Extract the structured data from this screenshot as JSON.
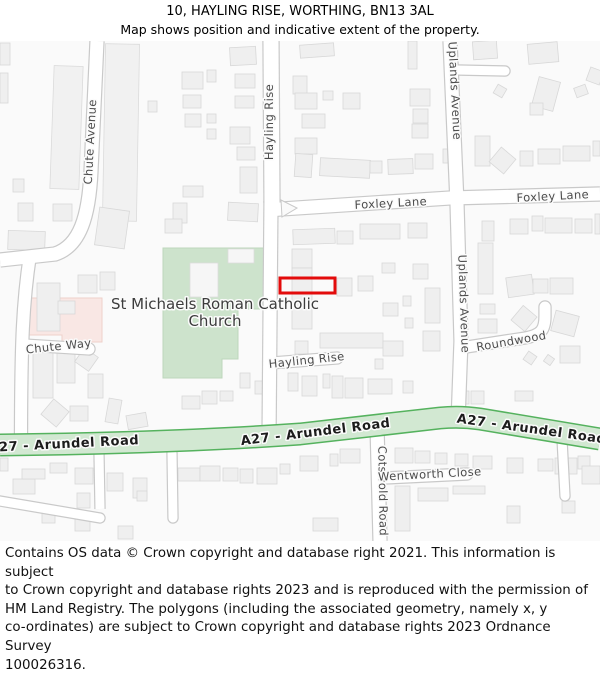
{
  "header": {
    "title": "10, HAYLING RISE, WORTHING, BN13 3AL",
    "subtitle": "Map shows position and indicative extent of the property."
  },
  "footer": {
    "lines": [
      "Contains OS data © Crown copyright and database right 2021. This information is subject",
      "to Crown copyright and database rights 2023 and is reproduced with the permission of",
      "HM Land Registry. The polygons (including the associated geometry, namely x, y",
      "co-ordinates) are subject to Crown copyright and database rights 2023 Ordnance Survey",
      "100026316."
    ]
  },
  "map": {
    "colors": {
      "land": "#fafafa",
      "building_fill": "#efefef",
      "building_stroke": "#d8d8d8",
      "strip_fill": "#f1f1f1",
      "strip_stroke": "#dbdbdb",
      "road_fill": "#ffffff",
      "road_casing": "#c9c9c9",
      "church_fill": "#cde3cc",
      "church_stroke": "#bdd7bc",
      "church_building_fill": "#f6f6f6",
      "pink_fill": "#f9e7e4",
      "pink_stroke": "#eed0ca",
      "a27_fill": "#d2e8d2",
      "a27_casing": "#55b25e",
      "label_color": "#4c4c4c",
      "a27_label_color": "#1c1c1c",
      "church_label_color": "#3c3c3c",
      "halo": "#fbfbfb",
      "marker": "#e30b0b"
    },
    "church": {
      "points": "163,207 265,207 265,268 238,268 238,318 222,318 222,337 163,337",
      "label_line1": "St Michaels Roman Catholic",
      "label_line2": "Church",
      "lx": 215,
      "ly1": 268,
      "ly2": 285,
      "buildings": [
        [
          190,
          222,
          28,
          34,
          0
        ],
        [
          228,
          208,
          26,
          14,
          0
        ]
      ]
    },
    "pink_area": {
      "points": "28,257 102,257 102,301 62,301 62,294 28,294"
    },
    "strips": [
      [
        52,
        25,
        29,
        123,
        2
      ],
      [
        104,
        3,
        34,
        177,
        1
      ]
    ],
    "roads": [
      {
        "name": "chute-avenue",
        "d": "M 97,0 L 91,130 C 89,175 80,205 55,213 L 0,219",
        "w": 13
      },
      {
        "name": "chute-avenue-south",
        "d": "M 30,214 C 23,260 21,300 21,402",
        "w": 12
      },
      {
        "name": "chute-way",
        "d": "M 25,304 L 89,308",
        "w": 11,
        "cap": "round"
      },
      {
        "name": "hayling-rise-north",
        "d": "M 271,0 L 272,162",
        "w": 15
      },
      {
        "name": "foxley-lane",
        "d": "M 266,169 L 450,157 L 600,153",
        "w": 13
      },
      {
        "name": "hayling-rise-south",
        "d": "M 271,160 L 269,398",
        "w": 13
      },
      {
        "name": "hayling-rise-stub",
        "d": "M 271,322 L 337,317",
        "w": 11,
        "cap": "round"
      },
      {
        "name": "uplands-avenue",
        "d": "M 450,0 L 457,162 L 461,300 L 458,380",
        "w": 13
      },
      {
        "name": "uplands-side-road",
        "d": "M 457,29 L 505,30",
        "w": 9,
        "cap": "round"
      },
      {
        "name": "roundwood",
        "d": "M 460,307 L 525,297 C 542,294 545,288 545,275 L 545,266",
        "w": 11,
        "cap": "round"
      },
      {
        "name": "cotswold-road",
        "d": "M 377,385 L 380,500",
        "w": 13
      },
      {
        "name": "wentworth-close",
        "d": "M 385,437 L 467,433",
        "w": 11,
        "cap": "round"
      },
      {
        "name": "driveway-1",
        "d": "M 99,412 L 100,468",
        "w": 9
      },
      {
        "name": "driveway-2",
        "d": "M 172,412 L 173,477",
        "w": 9,
        "cap": "round"
      },
      {
        "name": "driveway-3",
        "d": "M 562,398 L 565,455",
        "w": 9,
        "cap": "round"
      },
      {
        "name": "bottom-left-lane",
        "d": "M 0,460 L 100,477",
        "w": 9,
        "cap": "round"
      }
    ],
    "junction_island": "281,159 297,167 282,176",
    "a27": {
      "d": "M 0,404 C 90,403 200,400 300,393 L 440,377 Q 460,375 480,378 L 600,398",
      "w": 20,
      "labels": [
        {
          "text": "A27 - Arundel Road",
          "x": 64,
          "y": 407,
          "r": -3
        },
        {
          "text": "A27 - Arundel Road",
          "x": 316,
          "y": 395,
          "r": -7
        },
        {
          "text": "A27 - Arundel Road",
          "x": 531,
          "y": 392,
          "r": 8
        }
      ]
    },
    "road_labels": [
      {
        "text": "Chute Avenue",
        "x": 94,
        "y": 101,
        "r": -87
      },
      {
        "text": "Hayling Rise",
        "x": 273,
        "y": 81,
        "r": -90
      },
      {
        "text": "Uplands Avenue",
        "x": 451,
        "y": 50,
        "r": 87
      },
      {
        "text": "Uplands Avenue",
        "x": 460,
        "y": 263,
        "r": 88
      },
      {
        "text": "Foxley Lane",
        "x": 391,
        "y": 166,
        "r": -3
      },
      {
        "text": "Foxley Lane",
        "x": 553,
        "y": 159,
        "r": -3
      },
      {
        "text": "Chute Way",
        "x": 59,
        "y": 309,
        "r": -6
      },
      {
        "text": "Hayling Rise",
        "x": 307,
        "y": 323,
        "r": -6
      },
      {
        "text": "Roundwood",
        "x": 512,
        "y": 304,
        "r": -10
      },
      {
        "text": "Cotswold Road",
        "x": 379,
        "y": 450,
        "r": 89
      },
      {
        "text": "Wentworth Close",
        "x": 430,
        "y": 437,
        "r": -3
      }
    ],
    "buildings": [
      [
        0,
        2,
        10,
        22,
        0
      ],
      [
        0,
        32,
        8,
        30,
        0
      ],
      [
        13,
        138,
        11,
        13,
        0
      ],
      [
        18,
        162,
        15,
        18,
        0
      ],
      [
        53,
        163,
        19,
        17,
        0
      ],
      [
        8,
        190,
        37,
        19,
        2
      ],
      [
        97,
        168,
        30,
        38,
        8
      ],
      [
        78,
        234,
        19,
        18,
        0
      ],
      [
        100,
        231,
        15,
        18,
        0
      ],
      [
        37,
        242,
        23,
        48,
        0
      ],
      [
        58,
        260,
        17,
        13,
        0
      ],
      [
        33,
        303,
        20,
        54,
        0
      ],
      [
        57,
        312,
        18,
        30,
        0
      ],
      [
        78,
        310,
        17,
        17,
        35
      ],
      [
        88,
        333,
        15,
        24,
        0
      ],
      [
        45,
        362,
        20,
        20,
        40
      ],
      [
        70,
        365,
        18,
        15,
        0
      ],
      [
        107,
        358,
        13,
        24,
        10
      ],
      [
        127,
        373,
        20,
        14,
        -10
      ],
      [
        182,
        355,
        18,
        13,
        0
      ],
      [
        202,
        350,
        15,
        13,
        0
      ],
      [
        220,
        350,
        13,
        10,
        0
      ],
      [
        148,
        60,
        9,
        11,
        0
      ],
      [
        182,
        31,
        21,
        17,
        0
      ],
      [
        207,
        29,
        9,
        12,
        0
      ],
      [
        183,
        54,
        18,
        13,
        0
      ],
      [
        185,
        73,
        16,
        13,
        0
      ],
      [
        207,
        73,
        9,
        9,
        0
      ],
      [
        207,
        88,
        9,
        10,
        0
      ],
      [
        230,
        6,
        26,
        18,
        -3
      ],
      [
        235,
        33,
        20,
        14,
        0
      ],
      [
        235,
        55,
        19,
        12,
        0
      ],
      [
        230,
        86,
        20,
        17,
        0
      ],
      [
        237,
        106,
        18,
        13,
        0
      ],
      [
        240,
        126,
        17,
        26,
        0
      ],
      [
        228,
        162,
        30,
        18,
        3
      ],
      [
        183,
        145,
        20,
        11,
        0
      ],
      [
        173,
        162,
        14,
        20,
        0
      ],
      [
        165,
        178,
        17,
        14,
        0
      ],
      [
        300,
        3,
        34,
        13,
        -4
      ],
      [
        293,
        35,
        14,
        18,
        0
      ],
      [
        295,
        52,
        22,
        16,
        0
      ],
      [
        343,
        52,
        17,
        16,
        0
      ],
      [
        323,
        50,
        10,
        9,
        0
      ],
      [
        302,
        73,
        23,
        14,
        0
      ],
      [
        295,
        97,
        22,
        16,
        0
      ],
      [
        295,
        113,
        17,
        23,
        4
      ],
      [
        320,
        118,
        50,
        18,
        3
      ],
      [
        410,
        48,
        20,
        17,
        0
      ],
      [
        413,
        68,
        15,
        14,
        0
      ],
      [
        412,
        83,
        16,
        14,
        0
      ],
      [
        408,
        0,
        9,
        28,
        0
      ],
      [
        370,
        120,
        12,
        12,
        0
      ],
      [
        388,
        118,
        25,
        15,
        -2
      ],
      [
        415,
        113,
        18,
        15,
        0
      ],
      [
        443,
        108,
        12,
        14,
        0
      ],
      [
        473,
        0,
        24,
        18,
        -4
      ],
      [
        528,
        2,
        30,
        20,
        -5
      ],
      [
        535,
        38,
        22,
        30,
        15
      ],
      [
        530,
        62,
        13,
        12,
        0
      ],
      [
        495,
        45,
        10,
        10,
        30
      ],
      [
        575,
        45,
        12,
        10,
        -20
      ],
      [
        588,
        28,
        14,
        14,
        20
      ],
      [
        475,
        95,
        15,
        30,
        0
      ],
      [
        493,
        110,
        19,
        19,
        40
      ],
      [
        520,
        110,
        13,
        15,
        0
      ],
      [
        538,
        108,
        22,
        15,
        0
      ],
      [
        563,
        105,
        27,
        15,
        0
      ],
      [
        593,
        100,
        7,
        15,
        0
      ],
      [
        293,
        188,
        42,
        15,
        -2
      ],
      [
        337,
        190,
        16,
        13,
        0
      ],
      [
        360,
        183,
        40,
        15,
        0
      ],
      [
        408,
        182,
        19,
        15,
        0
      ],
      [
        510,
        178,
        18,
        15,
        0
      ],
      [
        532,
        175,
        11,
        15,
        0
      ],
      [
        545,
        177,
        27,
        15,
        0
      ],
      [
        575,
        178,
        17,
        14,
        0
      ],
      [
        595,
        173,
        5,
        20,
        0
      ],
      [
        478,
        202,
        15,
        51,
        0
      ],
      [
        482,
        180,
        12,
        20,
        0
      ],
      [
        292,
        208,
        20,
        19,
        0
      ],
      [
        292,
        227,
        20,
        61,
        0
      ],
      [
        337,
        237,
        15,
        18,
        0
      ],
      [
        358,
        235,
        15,
        15,
        0
      ],
      [
        382,
        222,
        13,
        10,
        0
      ],
      [
        383,
        262,
        15,
        13,
        0
      ],
      [
        403,
        255,
        8,
        10,
        0
      ],
      [
        413,
        223,
        15,
        15,
        0
      ],
      [
        425,
        247,
        15,
        35,
        0
      ],
      [
        405,
        277,
        8,
        10,
        0
      ],
      [
        423,
        290,
        17,
        20,
        0
      ],
      [
        295,
        300,
        13,
        13,
        0
      ],
      [
        320,
        292,
        63,
        15,
        0
      ],
      [
        383,
        300,
        20,
        15,
        0
      ],
      [
        507,
        235,
        26,
        20,
        -8
      ],
      [
        533,
        238,
        15,
        14,
        0
      ],
      [
        550,
        237,
        23,
        16,
        0
      ],
      [
        515,
        268,
        18,
        19,
        40
      ],
      [
        553,
        272,
        24,
        21,
        15
      ],
      [
        480,
        263,
        15,
        10,
        0
      ],
      [
        478,
        278,
        19,
        14,
        0
      ],
      [
        560,
        305,
        20,
        17,
        0
      ],
      [
        525,
        312,
        10,
        10,
        35
      ],
      [
        545,
        315,
        8,
        8,
        35
      ],
      [
        288,
        332,
        10,
        18,
        0
      ],
      [
        302,
        335,
        15,
        20,
        0
      ],
      [
        323,
        333,
        7,
        14,
        0
      ],
      [
        332,
        335,
        11,
        22,
        0
      ],
      [
        345,
        337,
        18,
        20,
        0
      ],
      [
        368,
        338,
        24,
        15,
        0
      ],
      [
        403,
        340,
        10,
        12,
        0
      ],
      [
        375,
        318,
        8,
        10,
        0
      ],
      [
        240,
        332,
        10,
        15,
        0
      ],
      [
        255,
        340,
        12,
        13,
        0
      ],
      [
        455,
        350,
        14,
        13,
        0
      ],
      [
        471,
        350,
        13,
        13,
        0
      ],
      [
        515,
        350,
        18,
        10,
        0
      ],
      [
        0,
        417,
        8,
        13,
        0
      ],
      [
        13,
        438,
        22,
        15,
        0
      ],
      [
        22,
        428,
        23,
        10,
        0
      ],
      [
        50,
        422,
        17,
        10,
        0
      ],
      [
        75,
        427,
        18,
        16,
        0
      ],
      [
        77,
        452,
        13,
        15,
        0
      ],
      [
        107,
        432,
        16,
        18,
        0
      ],
      [
        133,
        437,
        14,
        20,
        0
      ],
      [
        178,
        427,
        22,
        13,
        0
      ],
      [
        200,
        425,
        20,
        15,
        0
      ],
      [
        223,
        427,
        15,
        13,
        0
      ],
      [
        240,
        428,
        13,
        14,
        0
      ],
      [
        257,
        427,
        20,
        16,
        0
      ],
      [
        280,
        423,
        10,
        10,
        0
      ],
      [
        300,
        415,
        18,
        15,
        0
      ],
      [
        330,
        413,
        8,
        12,
        0
      ],
      [
        340,
        408,
        20,
        14,
        0
      ],
      [
        395,
        407,
        18,
        15,
        0
      ],
      [
        415,
        410,
        15,
        12,
        0
      ],
      [
        435,
        412,
        12,
        11,
        0
      ],
      [
        455,
        413,
        13,
        12,
        0
      ],
      [
        473,
        415,
        19,
        13,
        0
      ],
      [
        507,
        417,
        16,
        15,
        0
      ],
      [
        538,
        418,
        15,
        12,
        0
      ],
      [
        555,
        417,
        22,
        16,
        0
      ],
      [
        578,
        415,
        12,
        13,
        0
      ],
      [
        582,
        425,
        18,
        18,
        0
      ],
      [
        42,
        468,
        13,
        14,
        0
      ],
      [
        75,
        475,
        15,
        15,
        0
      ],
      [
        118,
        485,
        15,
        13,
        0
      ],
      [
        137,
        450,
        10,
        10,
        0
      ],
      [
        313,
        477,
        25,
        13,
        0
      ],
      [
        395,
        445,
        15,
        45,
        0
      ],
      [
        418,
        447,
        30,
        13,
        0
      ],
      [
        453,
        445,
        32,
        8,
        0
      ],
      [
        507,
        465,
        13,
        17,
        0
      ],
      [
        562,
        460,
        13,
        12,
        0
      ]
    ],
    "property_marker": {
      "x": 280,
      "y": 237,
      "w": 55,
      "h": 15,
      "stroke_width": 3
    }
  }
}
